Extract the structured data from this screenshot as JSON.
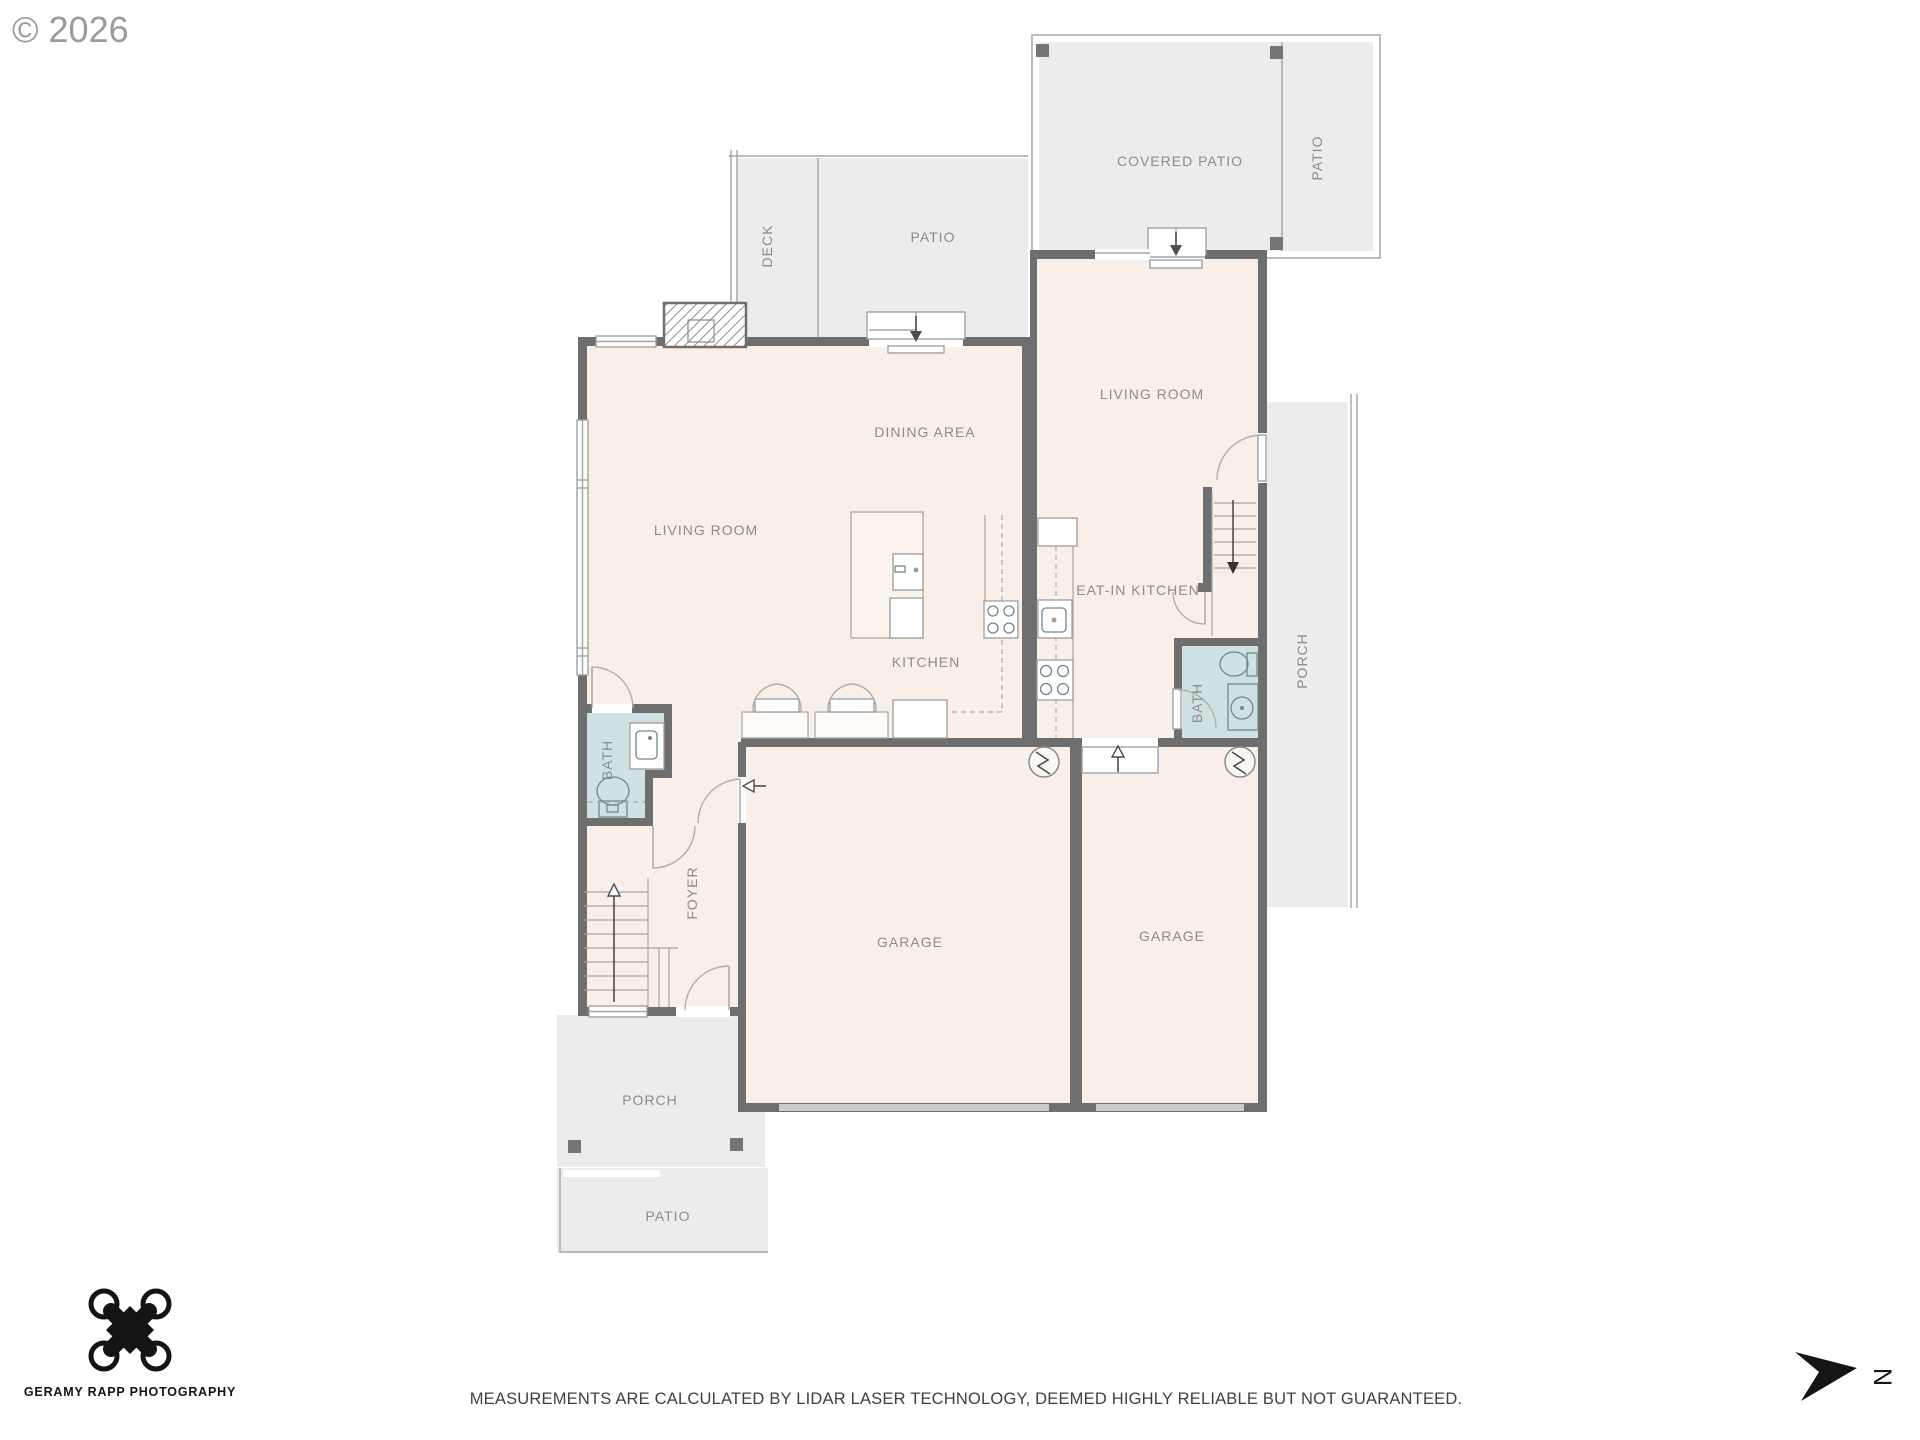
{
  "watermark": "© 2026",
  "rooms": {
    "covered_patio": "COVERED PATIO",
    "patio_upper_right": "PATIO",
    "deck": "DECK",
    "patio_upper": "PATIO",
    "dining_area": "DINING AREA",
    "living_room_left": "LIVING ROOM",
    "kitchen": "KITCHEN",
    "living_room_right": "LIVING ROOM",
    "eat_in_kitchen": "EAT-IN KITCHEN",
    "bath_left": "BATH",
    "bath_right": "BATH",
    "foyer": "FOYER",
    "garage_left": "GARAGE",
    "garage_right": "GARAGE",
    "porch_right": "PORCH",
    "porch_front": "PORCH",
    "patio_front": "PATIO"
  },
  "footer": {
    "brand": "GERAMY RAPP PHOTOGRAPHY",
    "disclaimer": "MEASUREMENTS ARE CALCULATED BY LIDAR LASER TECHNOLOGY, DEEMED HIGHLY RELIABLE BUT NOT GUARANTEED.",
    "north_label": "N"
  },
  "colors": {
    "wall": "#6e6e6e",
    "interior_fill": "#f8efe9",
    "bath_fill": "#cfe1e3",
    "outdoor_fill": "#ececec",
    "label": "#8c8c8c",
    "logo_ink": "#141414"
  }
}
